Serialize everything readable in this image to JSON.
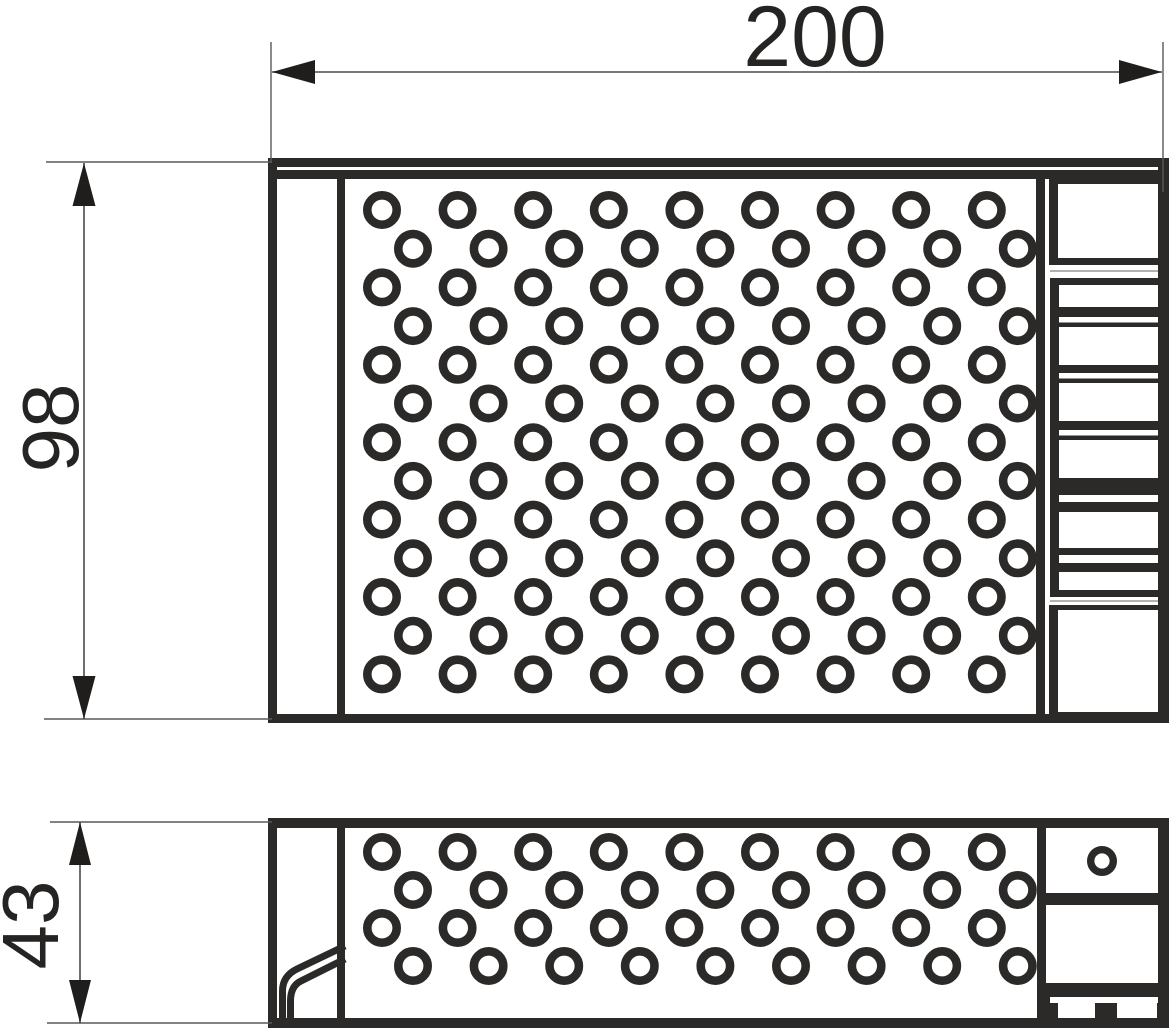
{
  "drawing": {
    "type": "technical-drawing",
    "subject": "perforated power supply enclosure - top view and side view",
    "dimension_labels": {
      "width": "200",
      "height": "98",
      "depth": "43"
    },
    "colors": {
      "line": "#2b2a29",
      "dim_line": "#4a4a49",
      "text": "#252422",
      "background": "#ffffff"
    }
  }
}
